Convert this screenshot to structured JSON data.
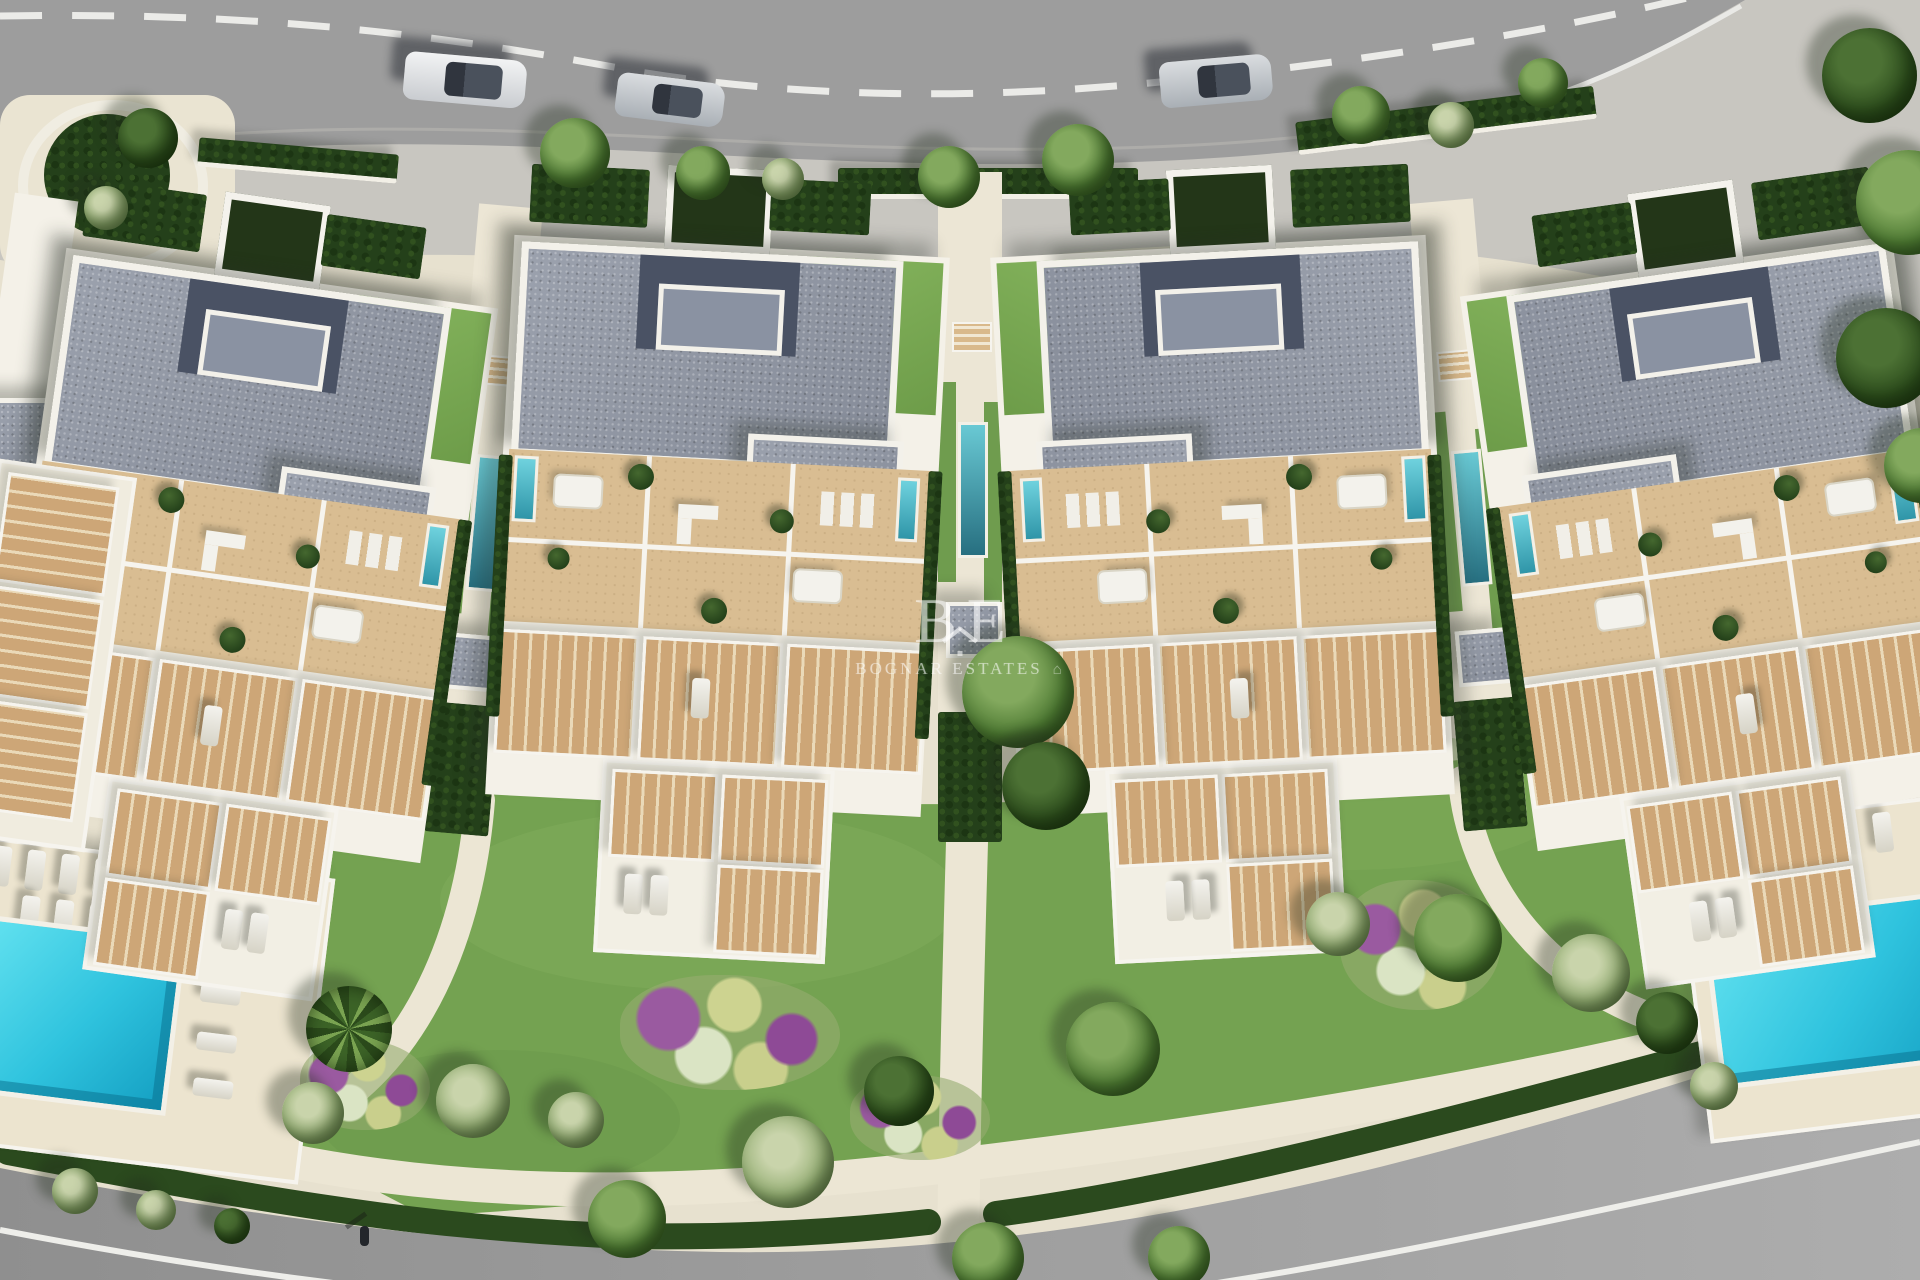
{
  "watermark": {
    "monogram_left": "B",
    "monogram_right": "E",
    "name": "BOGNAR ESTATES",
    "house_glyph": "⌂"
  },
  "scene": {
    "colors": {
      "pool_cyan": "#2fc3de",
      "lawn_green": "#74a251",
      "roof_gray": "#9099a6",
      "terrace_tan": "#d9bd92",
      "road_gray": "#9d9d9d",
      "path_cream": "#ece6d4",
      "hedge_green": "#2a461e"
    },
    "counts": {
      "buildings": 4,
      "cars": 3,
      "community_pools": 2,
      "walkway_lap_pools": 3
    }
  }
}
